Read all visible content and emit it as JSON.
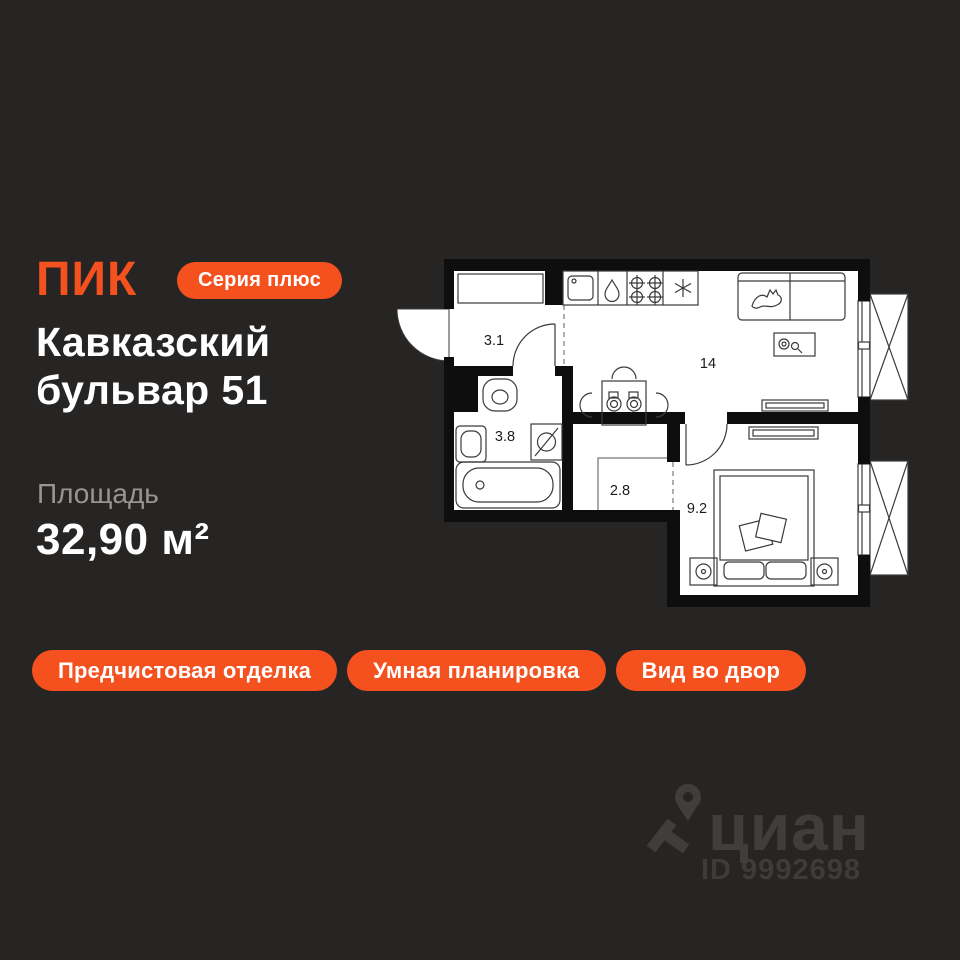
{
  "colors": {
    "background": "#262524",
    "accent": "#F4511E",
    "title": "#FFFFFF",
    "muted": "#9A968F",
    "plan-paper": "#FFFFFF",
    "plan-wall": "#0E0E0E",
    "watermark": "#403E3A"
  },
  "header": {
    "logo": "ПИК",
    "series_badge": "Серия плюс",
    "title_line1": "Кавказский",
    "title_line2": "бульвар 51"
  },
  "area": {
    "label": "Площадь",
    "value": "32,90 м²"
  },
  "tags": [
    {
      "label": "Предчистовая отделка"
    },
    {
      "label": "Умная планировка"
    },
    {
      "label": "Вид во двор"
    }
  ],
  "floor_plan": {
    "rooms": [
      {
        "name": "hallway",
        "area": "3.1"
      },
      {
        "name": "bathroom",
        "area": "3.8"
      },
      {
        "name": "kitchen-living-room",
        "area": "14"
      },
      {
        "name": "wardrobe",
        "area": "2.8"
      },
      {
        "name": "bedroom",
        "area": "9.2"
      }
    ],
    "fixtures": [
      "entry-door",
      "wardrobe-closet",
      "toilet",
      "wash-basin",
      "washing-machine",
      "bathtub",
      "kitchen-sink",
      "water-drop",
      "hob-burners",
      "fridge-snowflake",
      "dining-table",
      "chairs",
      "sofa",
      "cat",
      "coffee-table",
      "tv-console",
      "dresser",
      "bed",
      "pillows",
      "nightstands",
      "window",
      "balcony"
    ]
  },
  "watermark": {
    "brand": "циан",
    "listing_id": "ID 9992698"
  }
}
